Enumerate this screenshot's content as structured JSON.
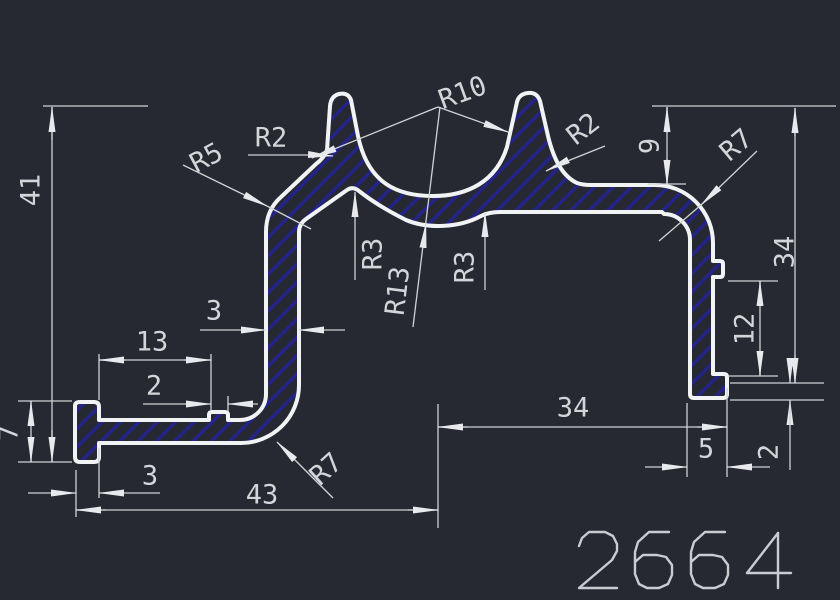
{
  "drawing": {
    "part_number": "2664",
    "dimensions": {
      "overall_height": "41",
      "flange_height": "7",
      "flange_width_bottom": "3",
      "base_width": "43",
      "arm_inset": "13",
      "notch_width": "2",
      "wall_thickness": "3",
      "channel_depth": "9",
      "right_height": "34",
      "right_base_width": "34",
      "leg_width": "5",
      "lip_height": "2",
      "lip_spacing": "12"
    },
    "radii": {
      "left_prong": "R2",
      "shoulder": "R5",
      "channel_inner": "R10",
      "channel_outer": "R13",
      "fillet_left": "R3",
      "fillet_right": "R3",
      "right_prong": "R2",
      "corner_top_right": "R7",
      "corner_bottom": "R7"
    },
    "colors": {
      "background": "#262931",
      "outline": "#f2f3f5",
      "hatch": "#23238a",
      "dimension": "#d0d2d6"
    }
  }
}
